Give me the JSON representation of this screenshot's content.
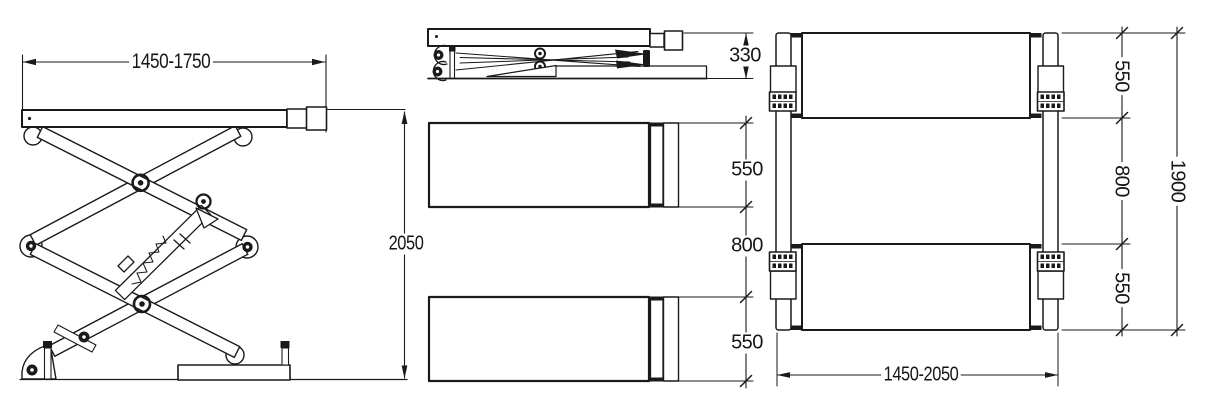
{
  "drawing": {
    "type": "engineering-dimension-drawing",
    "subject": "scissor-car-lift three-view diagram",
    "background": "#ffffff",
    "line_color": "#1a1a1a",
    "views": {
      "side_extended": {
        "platform_length": "1450-1750",
        "raised_height": "2050"
      },
      "collapsed": {
        "height": "330"
      },
      "top_view": {
        "platform_width_front": "550",
        "center_gap": "800",
        "platform_width_rear": "550"
      },
      "plan": {
        "platform_width_front": "550",
        "center_gap": "800",
        "platform_width_rear": "550",
        "overall_width": "1900",
        "platform_length_range": "1450-2050"
      }
    }
  }
}
